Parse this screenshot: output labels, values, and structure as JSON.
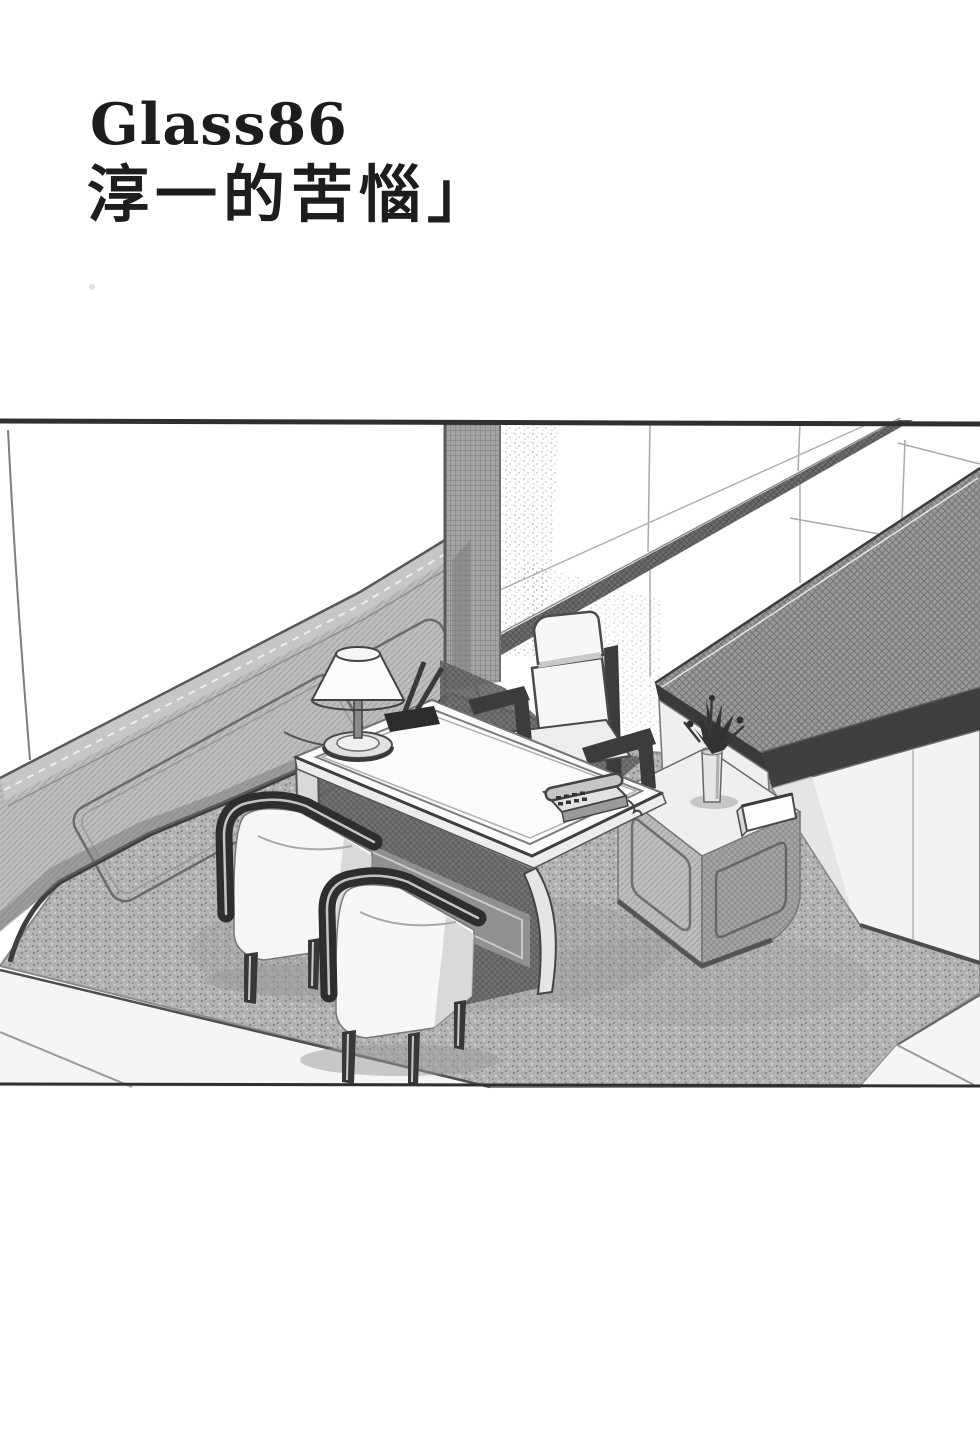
{
  "page": {
    "width_px": 980,
    "height_px": 1448,
    "background": "#ffffff"
  },
  "title": {
    "series_label": "Glass86",
    "chapter_title": "淳一的苦惱」"
  },
  "palette": {
    "ink": "#2e2e2e",
    "paper": "#ffffff",
    "carpet_gray": "#b3b3b3",
    "counter_top_gray": "#9a9a9a",
    "wainscot_gray": "#b0b0b0",
    "deep_shadow_gray": "#4a4a4a"
  },
  "illustration": {
    "kind": "black-and-white manga panel",
    "scene": "Office reception corner: wainscoted left wall, panelled back wall with ledge, long dark-topped counter, low cabinet with flower vase and folded card, writing desk with table lamp, pen stand and telephone, executive chair, two upholstered tub chairs on speckled carpet, tiled floor at the edges.",
    "objects": [
      "back-wall-panels",
      "wall-ledge",
      "corner-column",
      "wainscot",
      "office-desk",
      "desk-lamp",
      "pen-stand",
      "telephone",
      "executive-chair",
      "guest-chair-left",
      "guest-chair-right",
      "reception-counter",
      "low-cabinet",
      "flower-vase",
      "tent-card",
      "carpet",
      "tile-floor"
    ]
  }
}
